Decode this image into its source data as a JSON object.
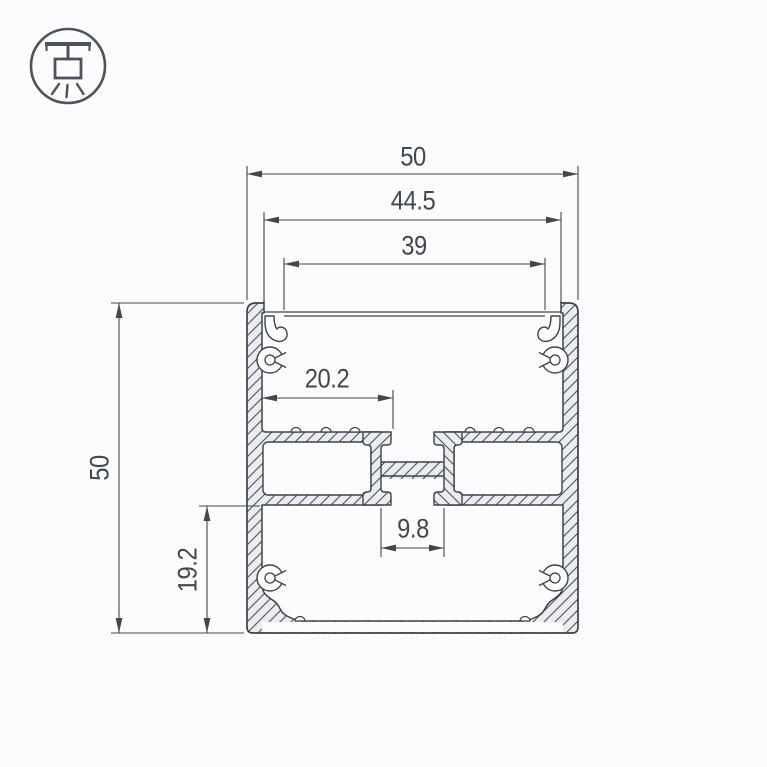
{
  "canvas": {
    "width": "767",
    "height": "767",
    "background": "#fcfcfc"
  },
  "colors": {
    "outline": "#3a434d",
    "dimension_line": "#3f4851",
    "metal_fill": "#eaecee",
    "hatch_line": "#4a525c"
  },
  "logo": {
    "icon": "pendant-light-icon"
  },
  "dimensions": {
    "top_outer_width": "50",
    "top_groove_width": "44.5",
    "top_opening_width": "39",
    "wall_to_center_slot": "20.2",
    "center_slot_width": "9.8",
    "side_outer_height": "50",
    "lower_section_height": "19.2"
  }
}
